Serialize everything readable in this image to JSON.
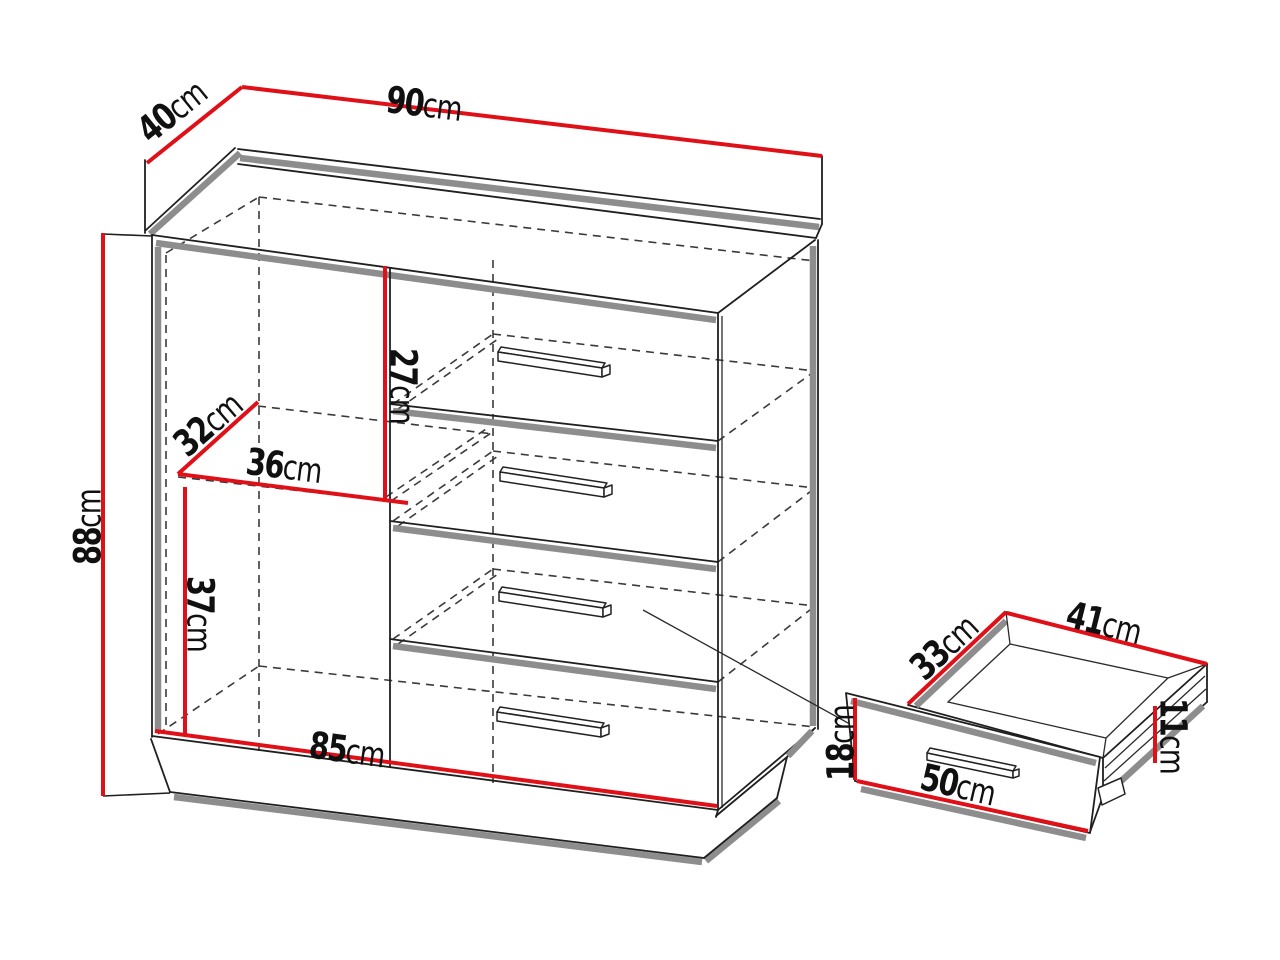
{
  "diagram_type": "furniture dimension drawing",
  "unit": "cm",
  "colors": {
    "dimension_line": "#e01018",
    "outline": "#1f1f1f",
    "shadow": "#8d8d8d",
    "background": "#ffffff"
  },
  "cabinet": {
    "description": "chest of drawers with side compartment and four drawers",
    "drawer_count": 4,
    "dimensions": {
      "width": "90",
      "depth": "40",
      "height": "88",
      "top_drawer_height": "27",
      "shelf_depth": "32",
      "shelf_width": "36",
      "lower_compartment_height": "37",
      "internal_width": "85"
    }
  },
  "drawer_detail": {
    "description": "pulled-out drawer box with front panel",
    "dimensions": {
      "inner_depth": "33",
      "inner_width": "41",
      "box_side_height": "11",
      "front_height": "18",
      "front_width": "50"
    }
  },
  "labels": [
    {
      "id": "width",
      "value": "90",
      "unit": "cm"
    },
    {
      "id": "depth",
      "value": "40",
      "unit": "cm"
    },
    {
      "id": "height",
      "value": "88",
      "unit": "cm"
    },
    {
      "id": "top-drawer-height",
      "value": "27",
      "unit": "cm"
    },
    {
      "id": "shelf-depth",
      "value": "32",
      "unit": "cm"
    },
    {
      "id": "shelf-width",
      "value": "36",
      "unit": "cm"
    },
    {
      "id": "lower-compartment-height",
      "value": "37",
      "unit": "cm"
    },
    {
      "id": "internal-width",
      "value": "85",
      "unit": "cm"
    },
    {
      "id": "drawer-depth",
      "value": "33",
      "unit": "cm"
    },
    {
      "id": "drawer-width",
      "value": "41",
      "unit": "cm"
    },
    {
      "id": "drawer-side-height",
      "value": "11",
      "unit": "cm"
    },
    {
      "id": "drawer-front-height",
      "value": "18",
      "unit": "cm"
    },
    {
      "id": "drawer-front-width",
      "value": "50",
      "unit": "cm"
    }
  ]
}
